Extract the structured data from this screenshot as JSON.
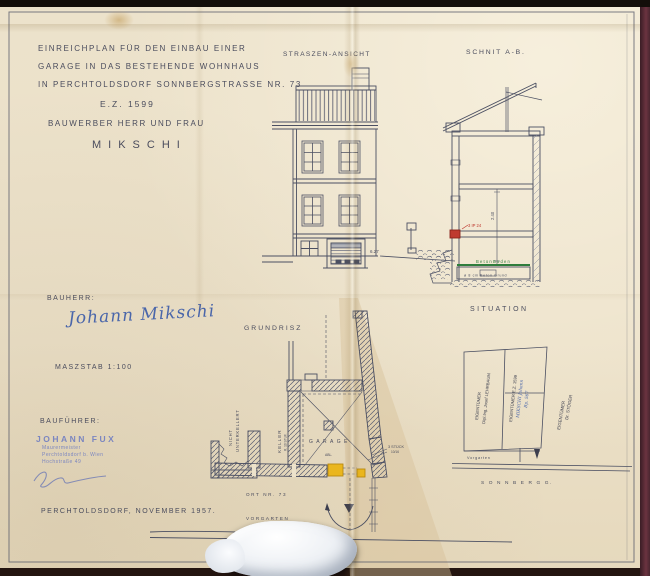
{
  "header": {
    "title_line1": "EINREICHPLAN FÜR DEN EINBAU EINER",
    "title_line2": "GARAGE IN DAS BESTEHENDE WOHNHAUS",
    "title_line3": "IN PERCHTOLDSDORF SONNBERGSTRASSE NR. 73",
    "parcel_no": "E.Z. 1599",
    "applicant_label": "BAUWERBER HERR UND FRAU",
    "applicant_name": "MIKSCHI"
  },
  "views": {
    "elevation_title": "STRASZEN-ANSICHT",
    "section_title": "SCHNIT A-B.",
    "floorplan_title": "GRUNDRISZ",
    "situation_title": "SITUATION"
  },
  "left_column": {
    "bauherr_label": "BAUHERR:",
    "bauherr_signature": "Johann Mikschi",
    "scale_label": "MASZSTAB 1:100",
    "baufuehrer_label": "BAUFÜHRER:",
    "stamp_name": "JOHANN FUX",
    "stamp_line2": "Maurermeister",
    "stamp_line3": "Perchtoldsdorf b. Wien",
    "stamp_line4": "Hochstraße 49",
    "date_place": "PERCHTOLDSDORF, NOVEMBER 1957."
  },
  "elevation": {
    "dim_ground": "6.27"
  },
  "section": {
    "beam_label": "3 IP 24",
    "floor_label": "BetonBoden",
    "foundation_label": "ø 8 cm Beton Grund",
    "dim_height": "2.40"
  },
  "floorplan": {
    "garage_label": "GARAGE",
    "abl_label": "ABL.",
    "keller_label": "KELLER",
    "keller_sub": "R. 10 STUF.",
    "nicht_label": "NICHT",
    "unterkellert_label": "UNTERKELLERT",
    "stueck_label": "3 STÜCK",
    "stueck_sub": "10/16",
    "ort_label": "ORT NR. 73",
    "vorgarten_label": "VORGARTEN",
    "street_label": "S O N N B E R G G."
  },
  "situation": {
    "owner_left_1": "EIGENTÜMER",
    "owner_left_2": "Dipl.Ing. Josef LEHRBAUM",
    "owner_mid_1": "EIGENTÜMER E.Z. 1599",
    "owner_mid_2": "MIKSCHI Johann",
    "owner_mid_3": "Bp. 567",
    "owner_right_1": "EIGENTÜMER",
    "owner_right_2": "Dr. STÖGER",
    "vorgarten_label": "Vorgarten",
    "street_label": "S O N N B E R G G."
  },
  "colors": {
    "ink": "#4b4f62",
    "paper": "#ece2cb",
    "blue_ink": "#4a66aa",
    "stamp_blue": "#7b86c0",
    "beam_red": "#bf3a30",
    "floor_green": "#2f7d3c",
    "new_wall_yellow": "#eab61e"
  }
}
